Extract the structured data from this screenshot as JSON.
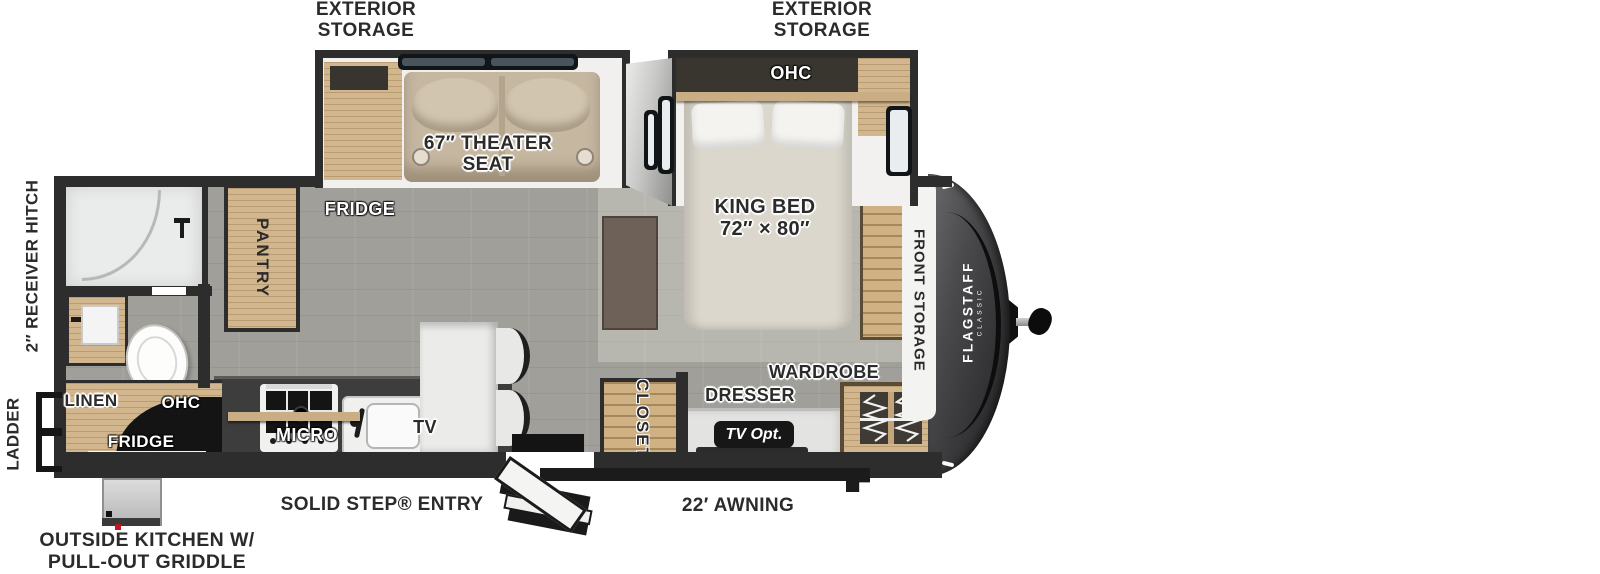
{
  "colors": {
    "wall": "#2d2d2d",
    "floor": "#a19f99",
    "wood": "#d2b68e",
    "slide_interior": "#f1f0ee",
    "front_cap": "#3f3f41",
    "theater_seat_tan": "#c6b7a1",
    "bed_beige": "#dbd7cd",
    "badge_black": "#171717",
    "label_dark": "#2b2b2b",
    "label_white": "#ffffff"
  },
  "top_labels": {
    "left": {
      "line1": "EXTERIOR",
      "line2": "STORAGE"
    },
    "right": {
      "line1": "EXTERIOR",
      "line2": "STORAGE"
    }
  },
  "living": {
    "theater_seat_line1": "67″ THEATER",
    "theater_seat_line2": "SEAT",
    "fridge": "FRIDGE",
    "pantry": "PANTRY",
    "micro": "MICRO",
    "tv": "TV"
  },
  "bedroom": {
    "ohc": "OHC",
    "king_bed_line1": "KING BED",
    "king_bed_line2": "72″ × 80″",
    "closet": "CLOSET",
    "dresser": "DRESSER",
    "tv_opt": "TV Opt.",
    "wardrobe": "WARDROBE",
    "front_storage": "FRONT STORAGE"
  },
  "outside_kitchen": {
    "linen": "LINEN",
    "ohc": "OHC",
    "fridge": "FRIDGE"
  },
  "exterior": {
    "receiver_hitch": "2″ RECEIVER HITCH",
    "ladder": "LADDER",
    "solid_step_entry": "SOLID STEP® ENTRY",
    "awning": "22′ AWNING",
    "outside_kitchen_line1": "OUTSIDE KITCHEN W/",
    "outside_kitchen_line2": "PULL-OUT GRIDDLE"
  },
  "brand": {
    "name": "FLAGSTAFF",
    "series": "CLASSIC"
  }
}
